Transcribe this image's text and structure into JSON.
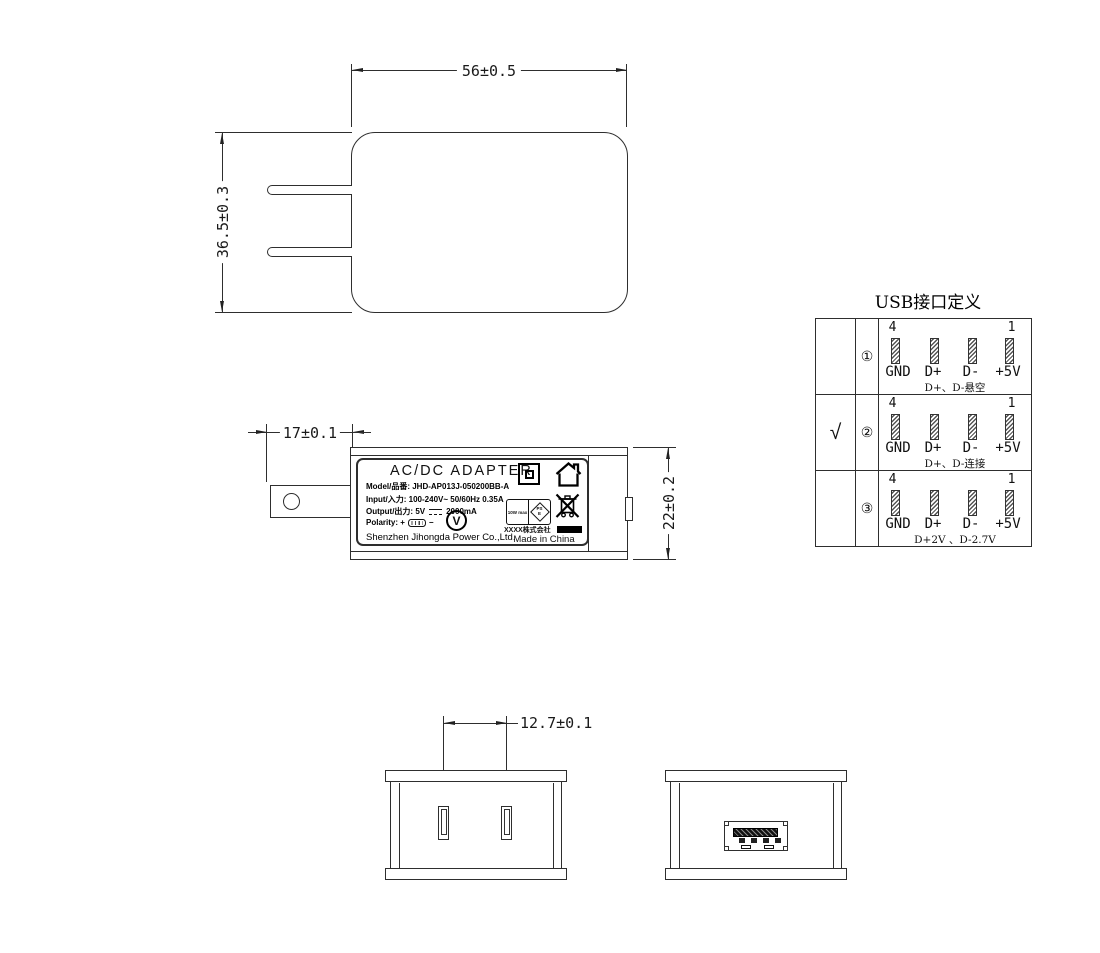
{
  "front_view": {
    "width_dim": "56±0.5",
    "height_dim": "36.5±0.3"
  },
  "side_view": {
    "blade_dim": "17±0.1",
    "thickness_dim": "22±0.2"
  },
  "bottom_view": {
    "pin_spacing_dim": "12.7±0.1"
  },
  "label": {
    "title": "AC/DC  ADAPTER",
    "model_line": "Model/品番: JHD-AP013J-050200BB-A",
    "input_line": "Input/入力: 100-240V~  50/60Hz  0.35A",
    "output_prefix": "Output/出力: 5V",
    "output_suffix": "2000mA",
    "polarity_label": "Polarity:",
    "polarity_plus": "+",
    "polarity_minus": "−",
    "company": "Shenzhen Jihongda Power Co.,Ltd.",
    "efficiency_mark": "V",
    "pse_left_text": "10W max",
    "pse_diamond_top": "PS",
    "pse_diamond_bottom": "E",
    "importer": "XXXX株式会社",
    "origin": "Made in China"
  },
  "usb_table": {
    "title": "USB接口定义",
    "pin_number_left": "4",
    "pin_number_right": "1",
    "pin_labels": [
      "GND",
      "D+",
      "D-",
      "+5V"
    ],
    "rows": [
      {
        "check": "",
        "index": "①",
        "note": "D+、D-悬空"
      },
      {
        "check": "√",
        "index": "②",
        "note": "D+、D-连接"
      },
      {
        "check": "",
        "index": "③",
        "note": "D+2V 、D-2.7V"
      }
    ]
  },
  "colors": {
    "line": "#2e2e2e",
    "ink": "#000000"
  }
}
